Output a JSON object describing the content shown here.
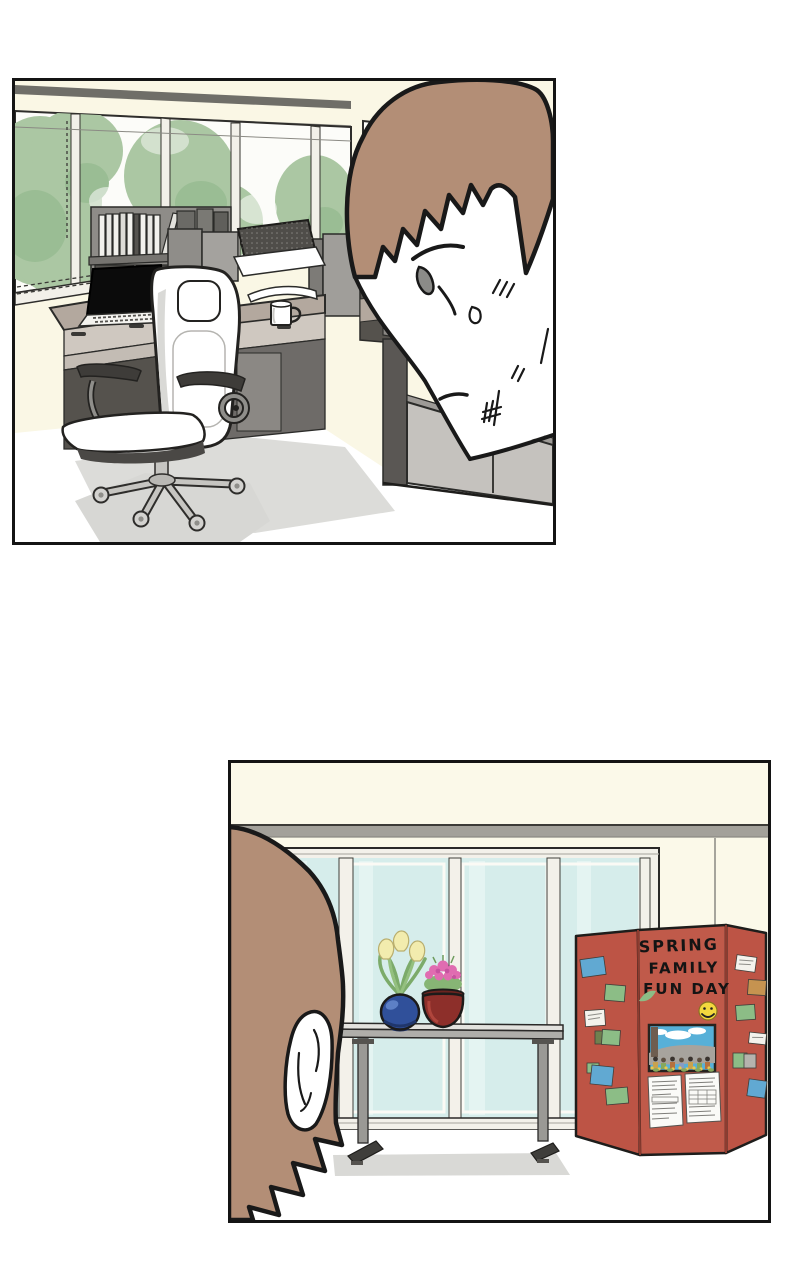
{
  "page": {
    "background": "#ffffff",
    "panel_border": "#141414"
  },
  "colors": {
    "outline": "#191919",
    "hair": "#b38e76",
    "skin": "#ffffff",
    "wall_cream": "#faf7e5",
    "wall_cream_2": "#fbf9e9",
    "top_band_gray": "#6f6e68",
    "beam_gray": "#a3a19a",
    "tree_green": "#abc7a3",
    "tree_green_dark": "#9abd94",
    "window_sky": "#fcfcf9",
    "glass_teal": "#d6edeb",
    "desk_taupe": "#b3a89e",
    "drawer_light": "#cfc8c0",
    "cavity_dark": "#55524d",
    "partition_gray": "#a09e9a",
    "cabinet_light": "#c5c2be",
    "chair_white": "#ffffff",
    "armrest_dark": "#3e3c39",
    "metal_silver": "#c6c5c1",
    "shadow_gray": "#d7d7d4",
    "board_red": "#bd5445",
    "smiley_yellow": "#f3d83e",
    "pot_blue": "#30509a",
    "pot_red": "#8d2f2a",
    "flower_pink": "#e06cb1",
    "tulip_yellow": "#f2ecae",
    "plant_green": "#7cab6a",
    "note_green": "#8cbd86",
    "note_blue": "#61a9d2",
    "note_tan": "#c69350",
    "note_white": "#f4f2ec",
    "photo_sky": "#57b0d8"
  },
  "panel2": {
    "board": {
      "line1": "SPRING",
      "line2": "FAMILY",
      "line3": "FUN DAY"
    }
  }
}
